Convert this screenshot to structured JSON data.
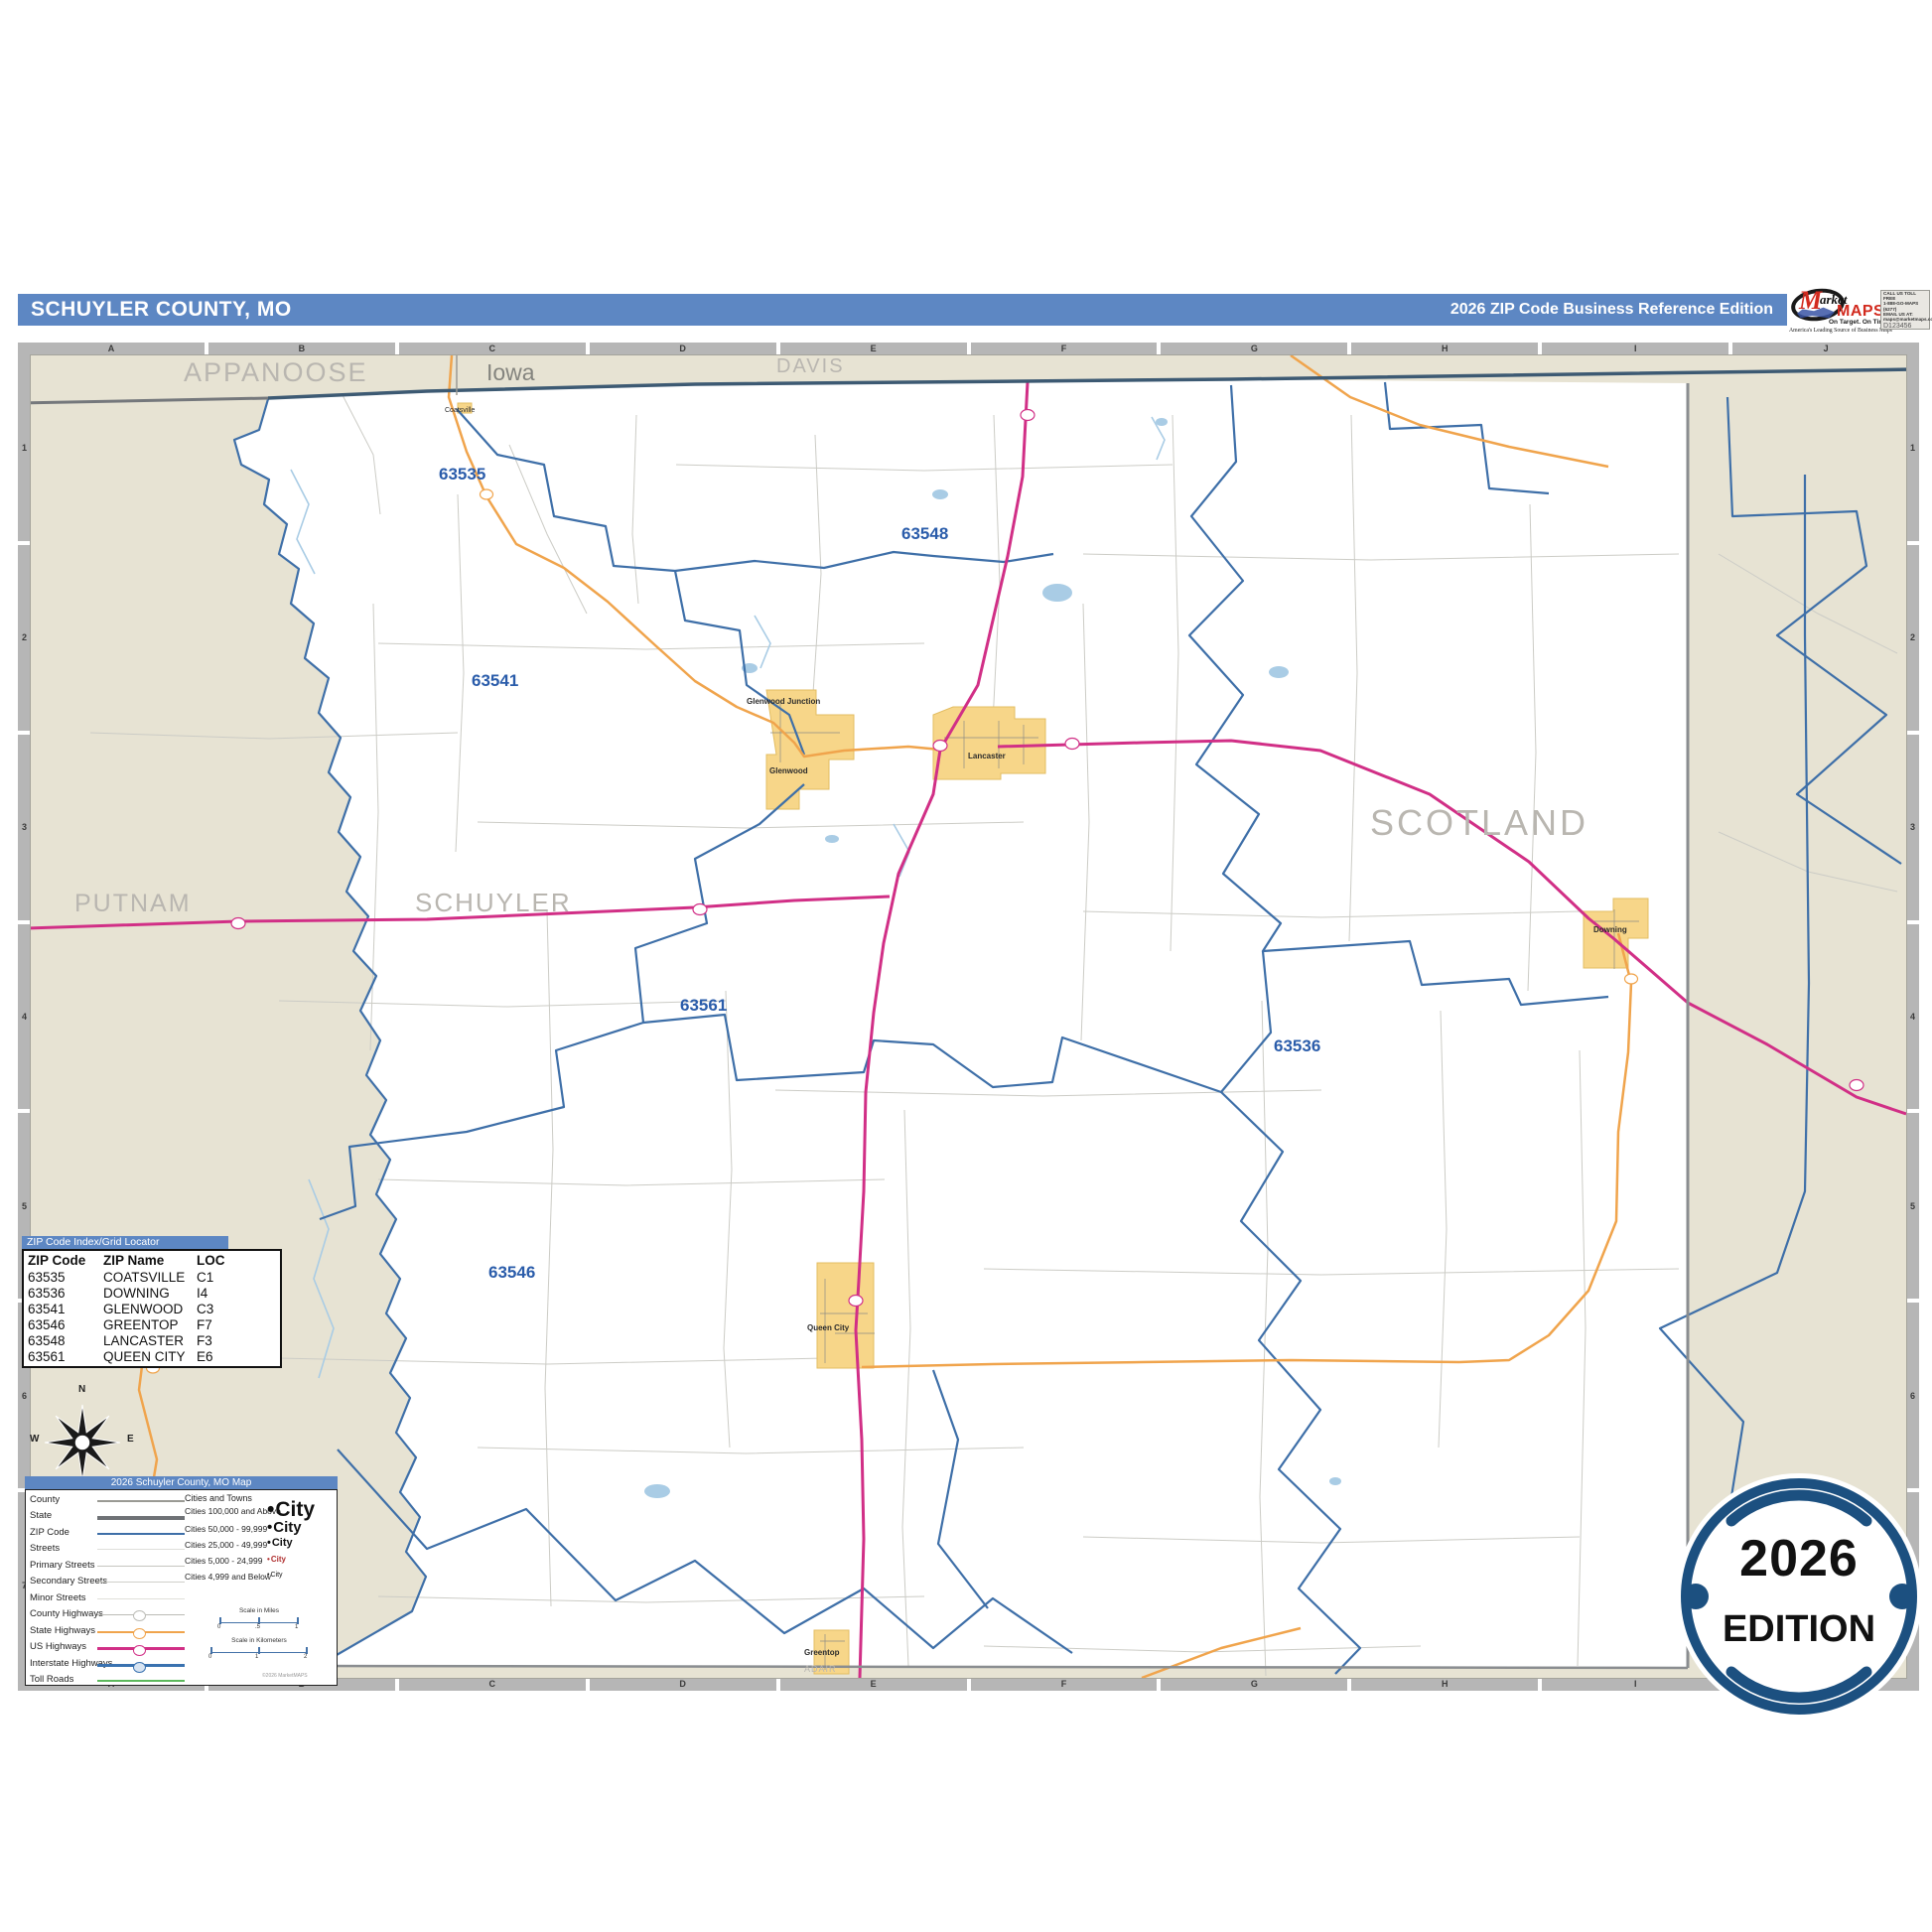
{
  "header": {
    "title": "SCHUYLER COUNTY, MO",
    "edition": "2026 ZIP Code Business Reference Edition"
  },
  "logo": {
    "m": "M",
    "arket": "arket",
    "maps": "MAPS",
    "tagline": "On Target.  On Time.",
    "subtitle": "America's Leading Source of Business Maps",
    "contact1": "CALL US TOLL FREE",
    "contact2": "1-888-GO-MAPS (6277)",
    "contact3": "EMAIL US AT:",
    "contact4": "maps@marketmaps.com",
    "product_code": "D123456"
  },
  "grid": {
    "columns": [
      "A",
      "B",
      "C",
      "D",
      "E",
      "F",
      "G",
      "H",
      "I",
      "J"
    ],
    "rows": [
      "1",
      "2",
      "3",
      "4",
      "5",
      "6",
      "7"
    ]
  },
  "map": {
    "state_label": "Iowa",
    "counties": {
      "appanoose": "APPANOOSE",
      "davis": "DAVIS",
      "putnam": "PUTNAM",
      "schuyler": "SCHUYLER",
      "scotland": "SCOTLAND",
      "adair": "ADAIR"
    },
    "zips": [
      "63535",
      "63548",
      "63541",
      "63561",
      "63536",
      "63546"
    ],
    "cities": {
      "glenwood_junction": "Glenwood Junction",
      "glenwood": "Glenwood",
      "lancaster": "Lancaster",
      "downing": "Downing",
      "queen_city": "Queen City",
      "greentop": "Greentop",
      "coatsville": "Coatsville"
    }
  },
  "index_table": {
    "header": "ZIP Code Index/Grid Locator",
    "columns": [
      "ZIP Code",
      "ZIP Name",
      "LOC"
    ],
    "rows": [
      [
        "63535",
        "COATSVILLE",
        "C1"
      ],
      [
        "63536",
        "DOWNING",
        "I4"
      ],
      [
        "63541",
        "GLENWOOD",
        "C3"
      ],
      [
        "63546",
        "GREENTOP",
        "F7"
      ],
      [
        "63548",
        "LANCASTER",
        "F3"
      ],
      [
        "63561",
        "QUEEN CITY",
        "E6"
      ]
    ]
  },
  "legend": {
    "title": "2026 Schuyler County, MO Map",
    "line_items": [
      "County",
      "State",
      "ZIP Code",
      "Streets",
      "Primary Streets",
      "Secondary Streets",
      "Minor Streets",
      "County Highways",
      "State Highways",
      "US Highways",
      "Interstate Highways",
      "Toll Roads"
    ],
    "cities_header": "Cities and Towns",
    "city_items": [
      {
        "label": "Cities 100,000 and Above",
        "sample": "City"
      },
      {
        "label": "Cities 50,000 - 99,999",
        "sample": "City"
      },
      {
        "label": "Cities 25,000 - 49,999",
        "sample": "City"
      },
      {
        "label": "Cities 5,000 - 24,999",
        "sample": "City"
      },
      {
        "label": "Cities 4,999 and Below",
        "sample": "City"
      }
    ],
    "scale_miles": {
      "title": "Scale in Miles",
      "ticks": [
        "0",
        ".5",
        "1"
      ]
    },
    "scale_km": {
      "title": "Scale in Kilometers",
      "ticks": [
        "0",
        "1",
        "2"
      ]
    },
    "copyright": "©2026 MarketMAPS"
  },
  "compass": {
    "n": "N",
    "e": "E",
    "s": "S",
    "w": "W"
  },
  "badge": {
    "year": "2026",
    "edition": "EDITION"
  },
  "colors": {
    "header_blue": "#5d87c3",
    "zip_boundary_blue": "#3e6fa8",
    "us_highway_pink": "#d12f86",
    "state_highway_orange": "#f0a44c",
    "city_fill_yellow": "#f7d689",
    "outside_beige": "#e7e3d3",
    "badge_navy": "#1c5080"
  }
}
